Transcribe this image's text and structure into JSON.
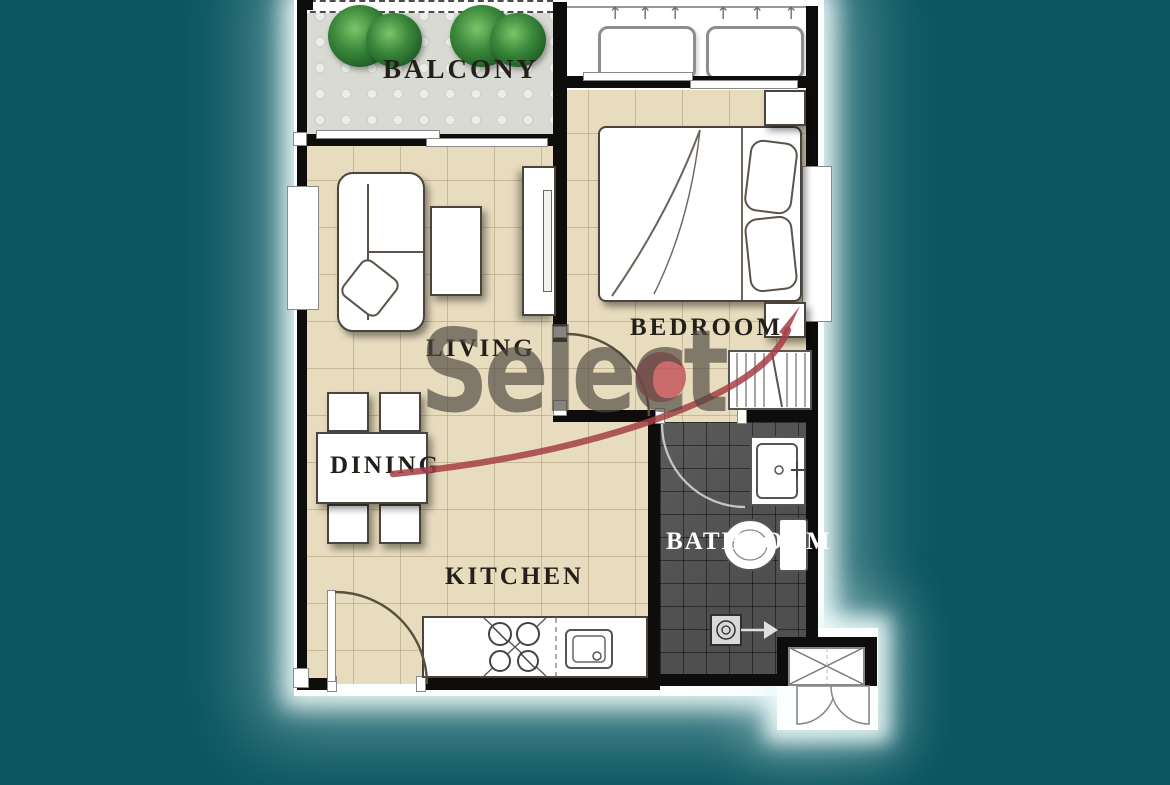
{
  "rooms": {
    "balcony": {
      "label": "BALCONY"
    },
    "bedroom": {
      "label": "BEDROOM"
    },
    "living": {
      "label": "LIVING"
    },
    "dining": {
      "label": "DINING"
    },
    "kitchen": {
      "label": "KITCHEN"
    },
    "bathroom": {
      "label": "BATHROOM"
    }
  },
  "watermark": {
    "text": "Select",
    "text_color": "#4e4841",
    "dot_color": "#c4525a",
    "swoosh_color": "#a53e45"
  },
  "icons": {
    "up_arrow": "↑",
    "names": [
      "plant-icon",
      "ac-unit-icon",
      "sliding-door-icon",
      "window-icon",
      "bed-icon",
      "pillow-icon",
      "nightstand-icon",
      "wardrobe-icon",
      "sofa-icon",
      "coffee-table-icon",
      "tv-console-icon",
      "dining-table-icon",
      "chair-icon",
      "door-swing-icon",
      "stove-icon",
      "kitchen-sink-icon",
      "bathroom-sink-icon",
      "toilet-icon",
      "shower-drain-icon",
      "entrance-double-door-icon"
    ]
  },
  "colors": {
    "background": "#0a5660",
    "floor_tile": "#e8dcbe",
    "balcony_floor": "#d8dad3",
    "bathroom_floor": "#4f4f4f",
    "wall": "#0e0d0c",
    "plant_green": "#3c8a3c"
  }
}
